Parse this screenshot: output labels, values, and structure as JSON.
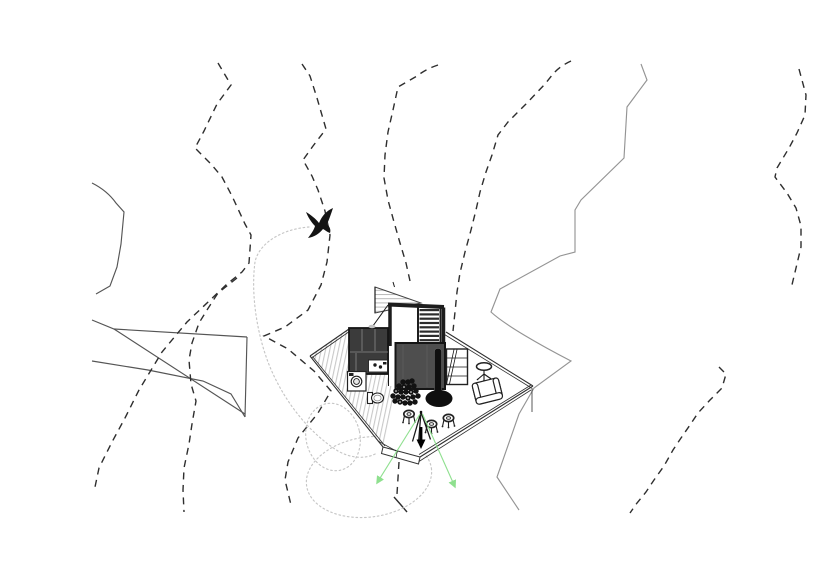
{
  "title": "cabin-site-plan-drawing",
  "colors": {
    "background": "#ffffff",
    "contour": "#2e2e2e",
    "terrain_line": "#949494",
    "rock_line": "#555555",
    "flight_path": "#c6c6c6",
    "sight_line": "#8fe08f",
    "wall": "#1d1d1d",
    "room_fill": "#4e4e4e",
    "cabinet_fill": "#3b3b3b",
    "stove": "#0f0f0f",
    "tread": "#2c2c2c",
    "hatch": "#c8c8c8",
    "roof_hatch": "#b8b8b8"
  },
  "scene": {
    "type": "architectural site / floor plan drawing, no text labels",
    "terrain": {
      "dashed_contour_lines": 8,
      "solid_ridge_lines": 2,
      "rock_outcrop_lines": 5
    },
    "bird": {
      "icon": "bird-icon",
      "style": "black silhouette, wings raised"
    },
    "flight_path": {
      "style": "dotted light gray",
      "loops": 2
    },
    "cabin": {
      "deck_shape": "pointed polygonal platform",
      "rooms": [
        "stair-landing",
        "staircase",
        "kitchen-unit",
        "corridor",
        "living-room"
      ],
      "fixtures": [
        "roof-plane-hatched",
        "kitchen-sink",
        "kitchen-counter",
        "washing-machine",
        "toilet",
        "firewood-pile",
        "wood-stove",
        "shelf-unit",
        "side-table",
        "armchair",
        "stool",
        "stool",
        "stool",
        "tripod",
        "down-arrow"
      ],
      "sight_lines": 2
    }
  }
}
